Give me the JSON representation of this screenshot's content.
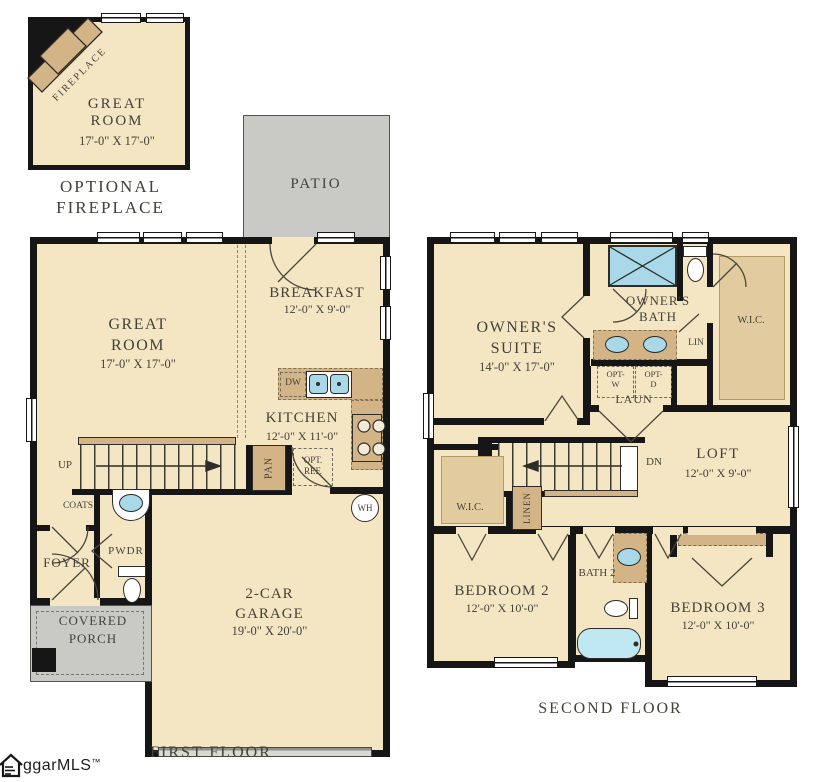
{
  "inset": {
    "fireplace": "FIREPLACE",
    "room": "GREAT ROOM",
    "dims": "17'-0\" X 17'-0\"",
    "caption": "OPTIONAL FIREPLACE"
  },
  "ff": {
    "caption": "FIRST FLOOR",
    "patio": "PATIO",
    "great_room": "GREAT ROOM",
    "great_room_dims": "17'-0\" X 17'-0\"",
    "breakfast": "BREAKFAST",
    "breakfast_dims": "12'-0\" X 9'-0\"",
    "kitchen": "KITCHEN",
    "kitchen_dims": "12'-0\" X 11'-0\"",
    "dw": "DW",
    "pan": "PAN",
    "opt_ref": "OPT. REF.",
    "up": "UP",
    "coats": "COATS",
    "pwdr": "PWDR",
    "foyer": "FOYER",
    "porch": "COVERED PORCH",
    "garage": "2-CAR GARAGE",
    "garage_dims": "19'-0\" X 20'-0\"",
    "wh": "WH"
  },
  "sf": {
    "caption": "SECOND FLOOR",
    "suite": "OWNER'S SUITE",
    "suite_dims": "14'-0\" X 17'-0\"",
    "bath": "OWNER'S BATH",
    "wic": "W.I.C.",
    "lin": "LIN",
    "opt_w1": "OPT-",
    "opt_w2": "W",
    "opt_d1": "OPT-",
    "opt_d2": "D",
    "laun": "LAUN",
    "dn": "DN",
    "loft": "LOFT",
    "loft_dims": "12'-0\" X 9'-0\"",
    "linen": "LINEN",
    "bedroom2": "BEDROOM 2",
    "bedroom2_dims": "12'-0\" X 10'-0\"",
    "bath2": "BATH 2",
    "bedroom3": "BEDROOM 3",
    "bedroom3_dims": "12'-0\" X 10'-0\""
  },
  "logo": {
    "text": "ggarMLS",
    "tm": "™"
  }
}
